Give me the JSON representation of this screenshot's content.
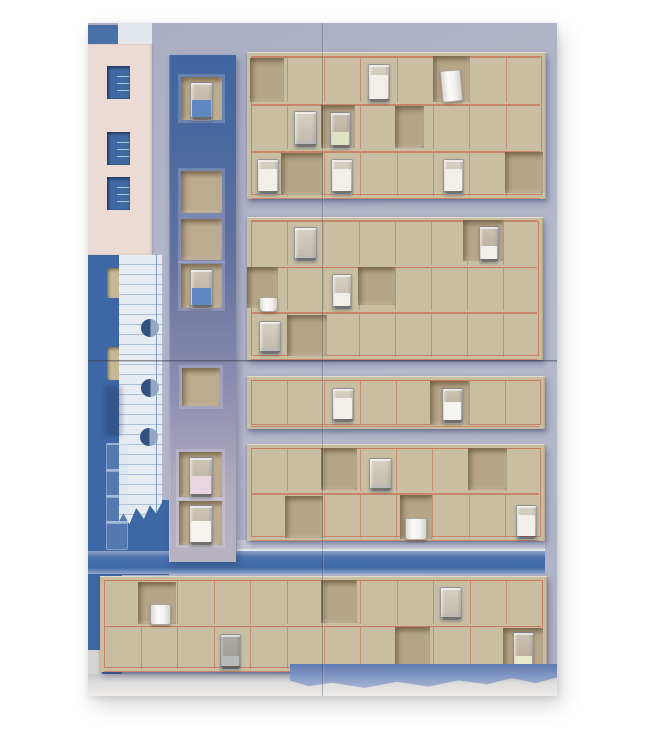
{
  "description": "Photograph of a mixed-media assemblage artwork: blue and lavender painted panels, pink paper with window cutouts, ruled notebook paper with punch holes, a vertical blue-to-grey column of square niches, and tan cardboard grid panels with red pencil lines whose cut niches hold small glasses of milk, water, blue and yellow liquid, and white ceramic cups.",
  "palette": {
    "page_bg": "#ffffff",
    "lavender": "#b2b6c9",
    "cobalt": "#3e68a5",
    "pink": "#ecdbd5",
    "cardboard": "#c9bda2",
    "niche_interior": "#b6a587",
    "red_line": "#c6745a",
    "paper": "#e7ebf2",
    "milk": "#f2efe9",
    "blue_liquid": "#6b90c6"
  },
  "scene": {
    "canvas": {
      "w": 647,
      "h": 740
    },
    "artwork": {
      "x": 88,
      "y": 23,
      "w": 469,
      "h": 673
    },
    "rects": [
      {
        "name": "top-left-blue-block",
        "x": 88,
        "y": 25,
        "w": 32,
        "h": 19,
        "fill": "#4a70a8"
      },
      {
        "name": "top-paper-band",
        "x": 118,
        "y": 23,
        "w": 34,
        "h": 21,
        "fill": "#e3e8ef",
        "cls": "paperband"
      },
      {
        "name": "left-blue-strip",
        "x": 88,
        "y": 255,
        "w": 34,
        "h": 420,
        "fill": "#3e68a5"
      },
      {
        "name": "paper-backing-blue",
        "x": 119,
        "y": 500,
        "w": 50,
        "h": 75,
        "fill": "#3e68a5"
      },
      {
        "name": "left-cutout-upper",
        "x": 107,
        "y": 268,
        "w": 21,
        "h": 30,
        "fill": "#c6b894",
        "cls": "cutout"
      },
      {
        "name": "left-cutout-lower",
        "x": 107,
        "y": 347,
        "w": 19,
        "h": 33,
        "fill": "#c6b894",
        "cls": "cutout"
      },
      {
        "name": "light-strip",
        "x": 237,
        "y": 540,
        "w": 308,
        "h": 11,
        "fill": "#c7cad9"
      },
      {
        "name": "white-edge-line",
        "x": 237,
        "y": 549,
        "w": 308,
        "h": 2,
        "fill": "#e9ebf1"
      },
      {
        "name": "blue-band",
        "x": 88,
        "y": 551,
        "w": 457,
        "h": 23,
        "grad": "linear-gradient(180deg,#8fa3c8 0%,#4a71ab 28%,#3f69a6 72%,#93a7cb 100%)"
      },
      {
        "name": "grey-step",
        "x": 88,
        "y": 650,
        "w": 14,
        "h": 46,
        "fill": "#d7d6d4"
      },
      {
        "name": "bottom-grey-strip",
        "x": 88,
        "y": 674,
        "w": 469,
        "h": 22,
        "grad": "linear-gradient(180deg,#c9c9cb,#dfdedc 45%,#ecebe9)"
      }
    ],
    "pink_panel": {
      "x": 88,
      "y": 44,
      "w": 64,
      "h": 211,
      "fill": "#ecdbd5",
      "window_fill": "#416aa4",
      "tick_color": "#a9c4dd",
      "windows": [
        {
          "x": 107,
          "y": 66,
          "w": 23,
          "h": 33
        },
        {
          "x": 107,
          "y": 132,
          "w": 23,
          "h": 33
        },
        {
          "x": 107,
          "y": 177,
          "w": 23,
          "h": 33
        }
      ]
    },
    "notebook": {
      "x": 119,
      "y": 255,
      "w": 43,
      "h": 272,
      "fill": "#e7ebf2",
      "line_color": "rgba(125,162,205,0.6)",
      "line_spacing": 10,
      "margin_x": 156,
      "hole_r": 9,
      "holes": [
        {
          "cx": 150,
          "cy": 328
        },
        {
          "cx": 150,
          "cy": 388
        },
        {
          "cx": 149,
          "cy": 437
        }
      ],
      "clip": "polygon(0 0,100% 0,100% 91%,86% 95%,72% 92%,58% 97%,40% 93%,24% 99%,10% 95%,0 98%)"
    },
    "ghost_glasses": {
      "x": 106,
      "y": 443,
      "w": 20,
      "h": 26,
      "count": 4
    },
    "smudge": {
      "x": 104,
      "y": 386,
      "w": 18,
      "h": 50
    },
    "column": {
      "x": 169,
      "y": 55,
      "w": 67,
      "h": 507,
      "grad": "linear-gradient(180deg,#40659f 0%,#49699f 18%,#66739f 42%,#8e8db0 66%,#b0abbe 85%,#b8b3c1 100%)",
      "niches": [
        {
          "x": 181,
          "y": 77,
          "w": 41,
          "h": 43,
          "glass": {
            "x": 190,
            "y": 82,
            "w": 21,
            "h": 37,
            "variant": "blue"
          }
        },
        {
          "x": 181,
          "y": 171,
          "w": 41,
          "h": 42
        },
        {
          "x": 181,
          "y": 219,
          "w": 41,
          "h": 41
        },
        {
          "x": 181,
          "y": 264,
          "w": 41,
          "h": 44,
          "glass": {
            "x": 190,
            "y": 269,
            "w": 21,
            "h": 38,
            "variant": "blue"
          }
        },
        {
          "x": 182,
          "y": 368,
          "w": 38,
          "h": 38
        },
        {
          "x": 179,
          "y": 452,
          "w": 43,
          "h": 45,
          "glass": {
            "x": 189,
            "y": 457,
            "w": 22,
            "h": 39,
            "variant": "pinkmilk"
          }
        },
        {
          "x": 179,
          "y": 501,
          "w": 43,
          "h": 44,
          "glass": {
            "x": 189,
            "y": 505,
            "w": 22,
            "h": 39,
            "variant": "whitemilk"
          }
        }
      ]
    },
    "panels": [
      {
        "name": "cardboard-panel-1",
        "x": 247,
        "y": 52,
        "w": 299,
        "h": 147,
        "cols": 8,
        "rows": [
          {
            "y": 57,
            "h": 46
          },
          {
            "y": 105,
            "h": 45
          },
          {
            "y": 152,
            "h": 45
          }
        ],
        "niches": [
          {
            "x": 250,
            "y": 58,
            "w": 34,
            "h": 44
          },
          {
            "x": 433,
            "y": 56,
            "w": 37,
            "h": 46
          },
          {
            "x": 321,
            "y": 105,
            "w": 34,
            "h": 43
          },
          {
            "x": 395,
            "y": 106,
            "w": 29,
            "h": 42
          },
          {
            "x": 281,
            "y": 153,
            "w": 42,
            "h": 42
          },
          {
            "x": 505,
            "y": 152,
            "w": 38,
            "h": 41
          }
        ],
        "glasses": [
          {
            "x": 368,
            "y": 64,
            "w": 20,
            "h": 37,
            "variant": "milk"
          },
          {
            "x": 441,
            "y": 70,
            "w": 19,
            "h": 30,
            "cup": true,
            "tilt": -5
          },
          {
            "x": 294,
            "y": 111,
            "w": 21,
            "h": 35,
            "variant": "water"
          },
          {
            "x": 330,
            "y": 112,
            "w": 19,
            "h": 35,
            "variant": "pale"
          },
          {
            "x": 257,
            "y": 159,
            "w": 20,
            "h": 34,
            "variant": "milk"
          },
          {
            "x": 331,
            "y": 159,
            "w": 20,
            "h": 34,
            "variant": "milk"
          },
          {
            "x": 443,
            "y": 159,
            "w": 19,
            "h": 34,
            "variant": "milk"
          }
        ]
      },
      {
        "name": "cardboard-panel-2",
        "x": 247,
        "y": 217,
        "w": 296,
        "h": 143,
        "cols": 8,
        "rows": [
          {
            "y": 220,
            "h": 46
          },
          {
            "y": 267,
            "h": 44
          },
          {
            "y": 313,
            "h": 45
          }
        ],
        "niches": [
          {
            "x": 463,
            "y": 220,
            "w": 40,
            "h": 41
          },
          {
            "x": 247,
            "y": 267,
            "w": 31,
            "h": 41
          },
          {
            "x": 358,
            "y": 267,
            "w": 37,
            "h": 38
          },
          {
            "x": 287,
            "y": 315,
            "w": 40,
            "h": 41
          }
        ],
        "glasses": [
          {
            "x": 294,
            "y": 227,
            "w": 21,
            "h": 33,
            "variant": "water"
          },
          {
            "x": 479,
            "y": 226,
            "w": 18,
            "h": 35,
            "variant": "halfmilk"
          },
          {
            "x": 259,
            "y": 297,
            "w": 17,
            "h": 13,
            "cup": true,
            "small": true
          },
          {
            "x": 332,
            "y": 274,
            "w": 18,
            "h": 34,
            "variant": "halfmilk"
          },
          {
            "x": 259,
            "y": 321,
            "w": 20,
            "h": 32,
            "variant": "water"
          }
        ]
      },
      {
        "name": "cardboard-panel-3",
        "x": 247,
        "y": 376,
        "w": 298,
        "h": 53,
        "cols": 8,
        "rows": [
          {
            "y": 380,
            "h": 45
          }
        ],
        "niches": [
          {
            "x": 430,
            "y": 381,
            "w": 39,
            "h": 44
          }
        ],
        "glasses": [
          {
            "x": 332,
            "y": 388,
            "w": 20,
            "h": 33,
            "variant": "milk"
          },
          {
            "x": 442,
            "y": 388,
            "w": 19,
            "h": 34,
            "variant": "whitemilk"
          }
        ]
      },
      {
        "name": "cardboard-panel-4",
        "x": 247,
        "y": 444,
        "w": 298,
        "h": 97,
        "cols": 8,
        "rows": [
          {
            "y": 448,
            "h": 44
          },
          {
            "y": 494,
            "h": 45
          }
        ],
        "niches": [
          {
            "x": 321,
            "y": 448,
            "w": 36,
            "h": 42
          },
          {
            "x": 468,
            "y": 448,
            "w": 39,
            "h": 42
          },
          {
            "x": 285,
            "y": 496,
            "w": 38,
            "h": 42
          },
          {
            "x": 400,
            "y": 495,
            "w": 32,
            "h": 44
          }
        ],
        "glasses": [
          {
            "x": 369,
            "y": 458,
            "w": 21,
            "h": 32,
            "variant": "water"
          },
          {
            "x": 405,
            "y": 518,
            "w": 20,
            "h": 20,
            "cup": true
          },
          {
            "x": 516,
            "y": 505,
            "w": 19,
            "h": 33,
            "variant": "milk"
          }
        ]
      },
      {
        "name": "cardboard-panel-5",
        "x": 100,
        "y": 576,
        "w": 447,
        "h": 96,
        "cols": 12,
        "rows": [
          {
            "y": 580,
            "h": 45
          },
          {
            "y": 626,
            "h": 44
          }
        ],
        "niches": [
          {
            "x": 138,
            "y": 582,
            "w": 38,
            "h": 42
          },
          {
            "x": 321,
            "y": 580,
            "w": 36,
            "h": 43
          },
          {
            "x": 395,
            "y": 627,
            "w": 35,
            "h": 41
          },
          {
            "x": 503,
            "y": 628,
            "w": 40,
            "h": 42
          }
        ],
        "glasses": [
          {
            "x": 150,
            "y": 604,
            "w": 19,
            "h": 19,
            "cup": true
          },
          {
            "x": 440,
            "y": 587,
            "w": 20,
            "h": 32,
            "variant": "water"
          },
          {
            "x": 220,
            "y": 634,
            "w": 19,
            "h": 34,
            "variant": "darkmilk"
          },
          {
            "x": 513,
            "y": 632,
            "w": 19,
            "h": 37,
            "variant": "paleyellow"
          }
        ]
      }
    ],
    "glass_variants": {
      "milk": {
        "liq": "#f2efe9",
        "level": 0.8
      },
      "whitemilk": {
        "liq": "#f6f4ef",
        "level": 0.66
      },
      "halfmilk": {
        "liq": "#f2efe9",
        "level": 0.48
      },
      "water": {
        "liq": "rgba(178,183,192,0.45)",
        "level": 0.12
      },
      "blue": {
        "liq": "#5f88c0",
        "level": 0.55
      },
      "pinkmilk": {
        "liq": "#e9d6e0",
        "level": 0.55
      },
      "pale": {
        "liq": "#dfe2c2",
        "level": 0.45
      },
      "paleyellow": {
        "liq": "#e7e9c8",
        "level": 0.35
      },
      "darkmilk": {
        "liq": "#eceae4",
        "level": 0.38,
        "tint": "rgba(92,97,110,0.35)"
      }
    },
    "torn_blue": {
      "x": 290,
      "y": 664,
      "w": 267,
      "h": 24,
      "grad": "linear-gradient(180deg,#5d7ab1,#7e94c2 45%,#a7b4d4)",
      "clip": "polygon(0 0,100% 0,100% 55%,92% 80%,83% 58%,74% 85%,63% 68%,52% 95%,40% 74%,28% 100%,16% 78%,7% 92%,0 70%)"
    },
    "seams": {
      "vertical": {
        "x": 322,
        "y1": 23,
        "y2": 696
      },
      "horizontal": {
        "y": 360,
        "x1": 88,
        "x2": 557
      }
    }
  }
}
